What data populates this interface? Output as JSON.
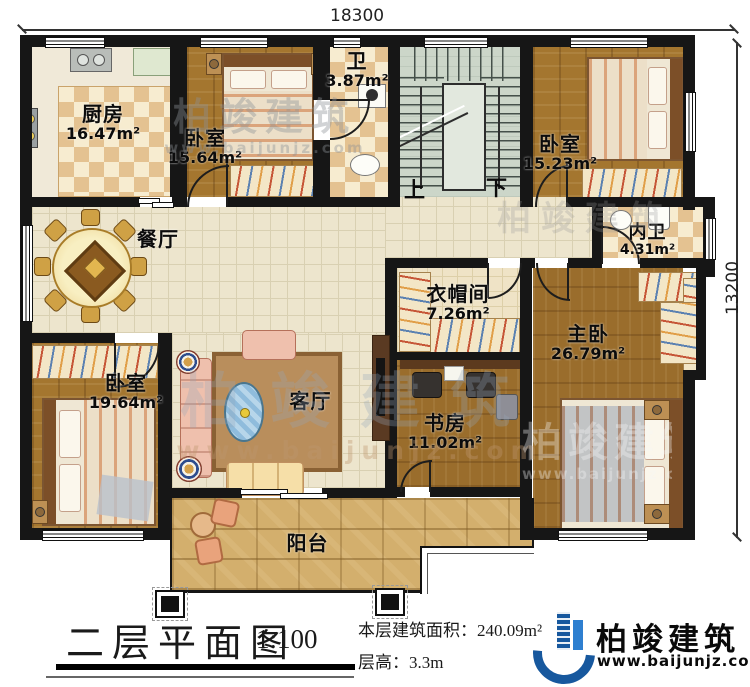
{
  "plan": {
    "dim_top": "18300",
    "dim_right": "13200",
    "rooms": {
      "kitchen": {
        "name": "厨房",
        "area": "16.47m²"
      },
      "bedroom1": {
        "name": "卧室",
        "area": "15.64m²"
      },
      "bath": {
        "name": "卫",
        "area": "3.87m²"
      },
      "bedroom2": {
        "name": "卧室",
        "area": "15.23m²"
      },
      "dining": {
        "name": "餐厅"
      },
      "inner_bath": {
        "name": "内卫",
        "area": "4.31m²"
      },
      "cloakroom": {
        "name": "衣帽间",
        "area": "7.26m²"
      },
      "master": {
        "name": "主卧",
        "area": "26.79m²"
      },
      "bedroom3": {
        "name": "卧室",
        "area": "19.64m²"
      },
      "living": {
        "name": "客厅"
      },
      "study": {
        "name": "书房",
        "area": "11.02m²"
      },
      "balcony": {
        "name": "阳台"
      }
    },
    "stairs": {
      "up": "上",
      "down": "下"
    }
  },
  "footer": {
    "title": "二层平面图",
    "scale": "1:100",
    "area_line": "本层建筑面积：240.09m²",
    "floor_height_line": "层高：3.3m",
    "brand": "柏竣建筑",
    "website": "www.baijunjz.com"
  },
  "watermark": {
    "brand": "柏竣建筑",
    "website": "www.baijunjz.com"
  },
  "colors": {
    "wall": "#161616",
    "wood": "#a4762f",
    "tile": "#ede5cd",
    "stone": "#d3af6d",
    "brand_blue": "#17589e"
  }
}
